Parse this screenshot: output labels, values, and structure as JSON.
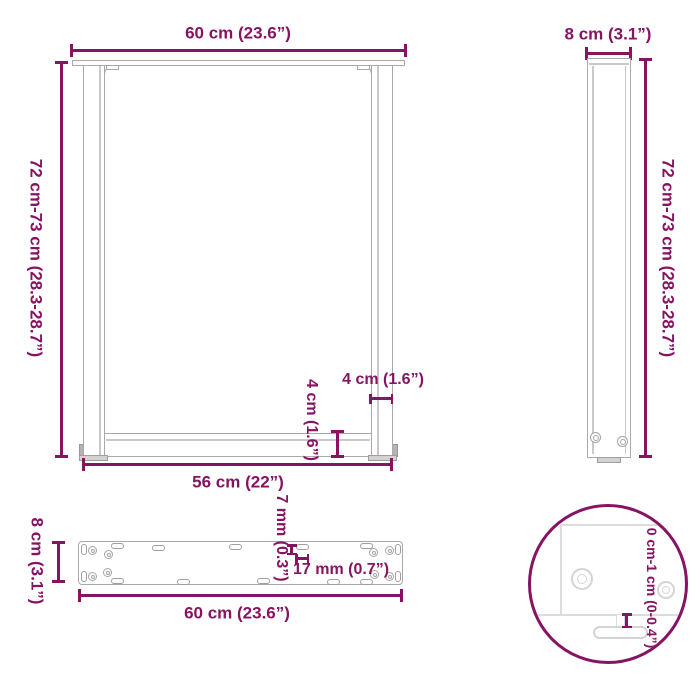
{
  "diagram": {
    "subject": "table-leg-dimension-diagram",
    "accent_color": "#861462",
    "drawing_line_color": "#a9a9a9",
    "detail_line_color": "#d8d8d8"
  },
  "front_view": {
    "width_top": "60 cm (23.6”)",
    "height": "72 cm-73 cm (28.3-28.7”)",
    "width_bottom": "56 cm (22”)",
    "leg_width": "4 cm (1.6”)",
    "crossbar_height": "4 cm (1.6”)"
  },
  "side_view": {
    "depth": "8 cm (3.1”)",
    "height": "72 cm-73 cm (28.3-28.7”)"
  },
  "plate_view": {
    "depth": "8 cm (3.1”)",
    "length": "60 cm (23.6”)",
    "hole_width": "7 mm (0.3”)",
    "hole_length": "17 mm (0.7”)"
  },
  "detail_view": {
    "adjustment_range": "0 cm-1 cm (0-0.4”)"
  }
}
